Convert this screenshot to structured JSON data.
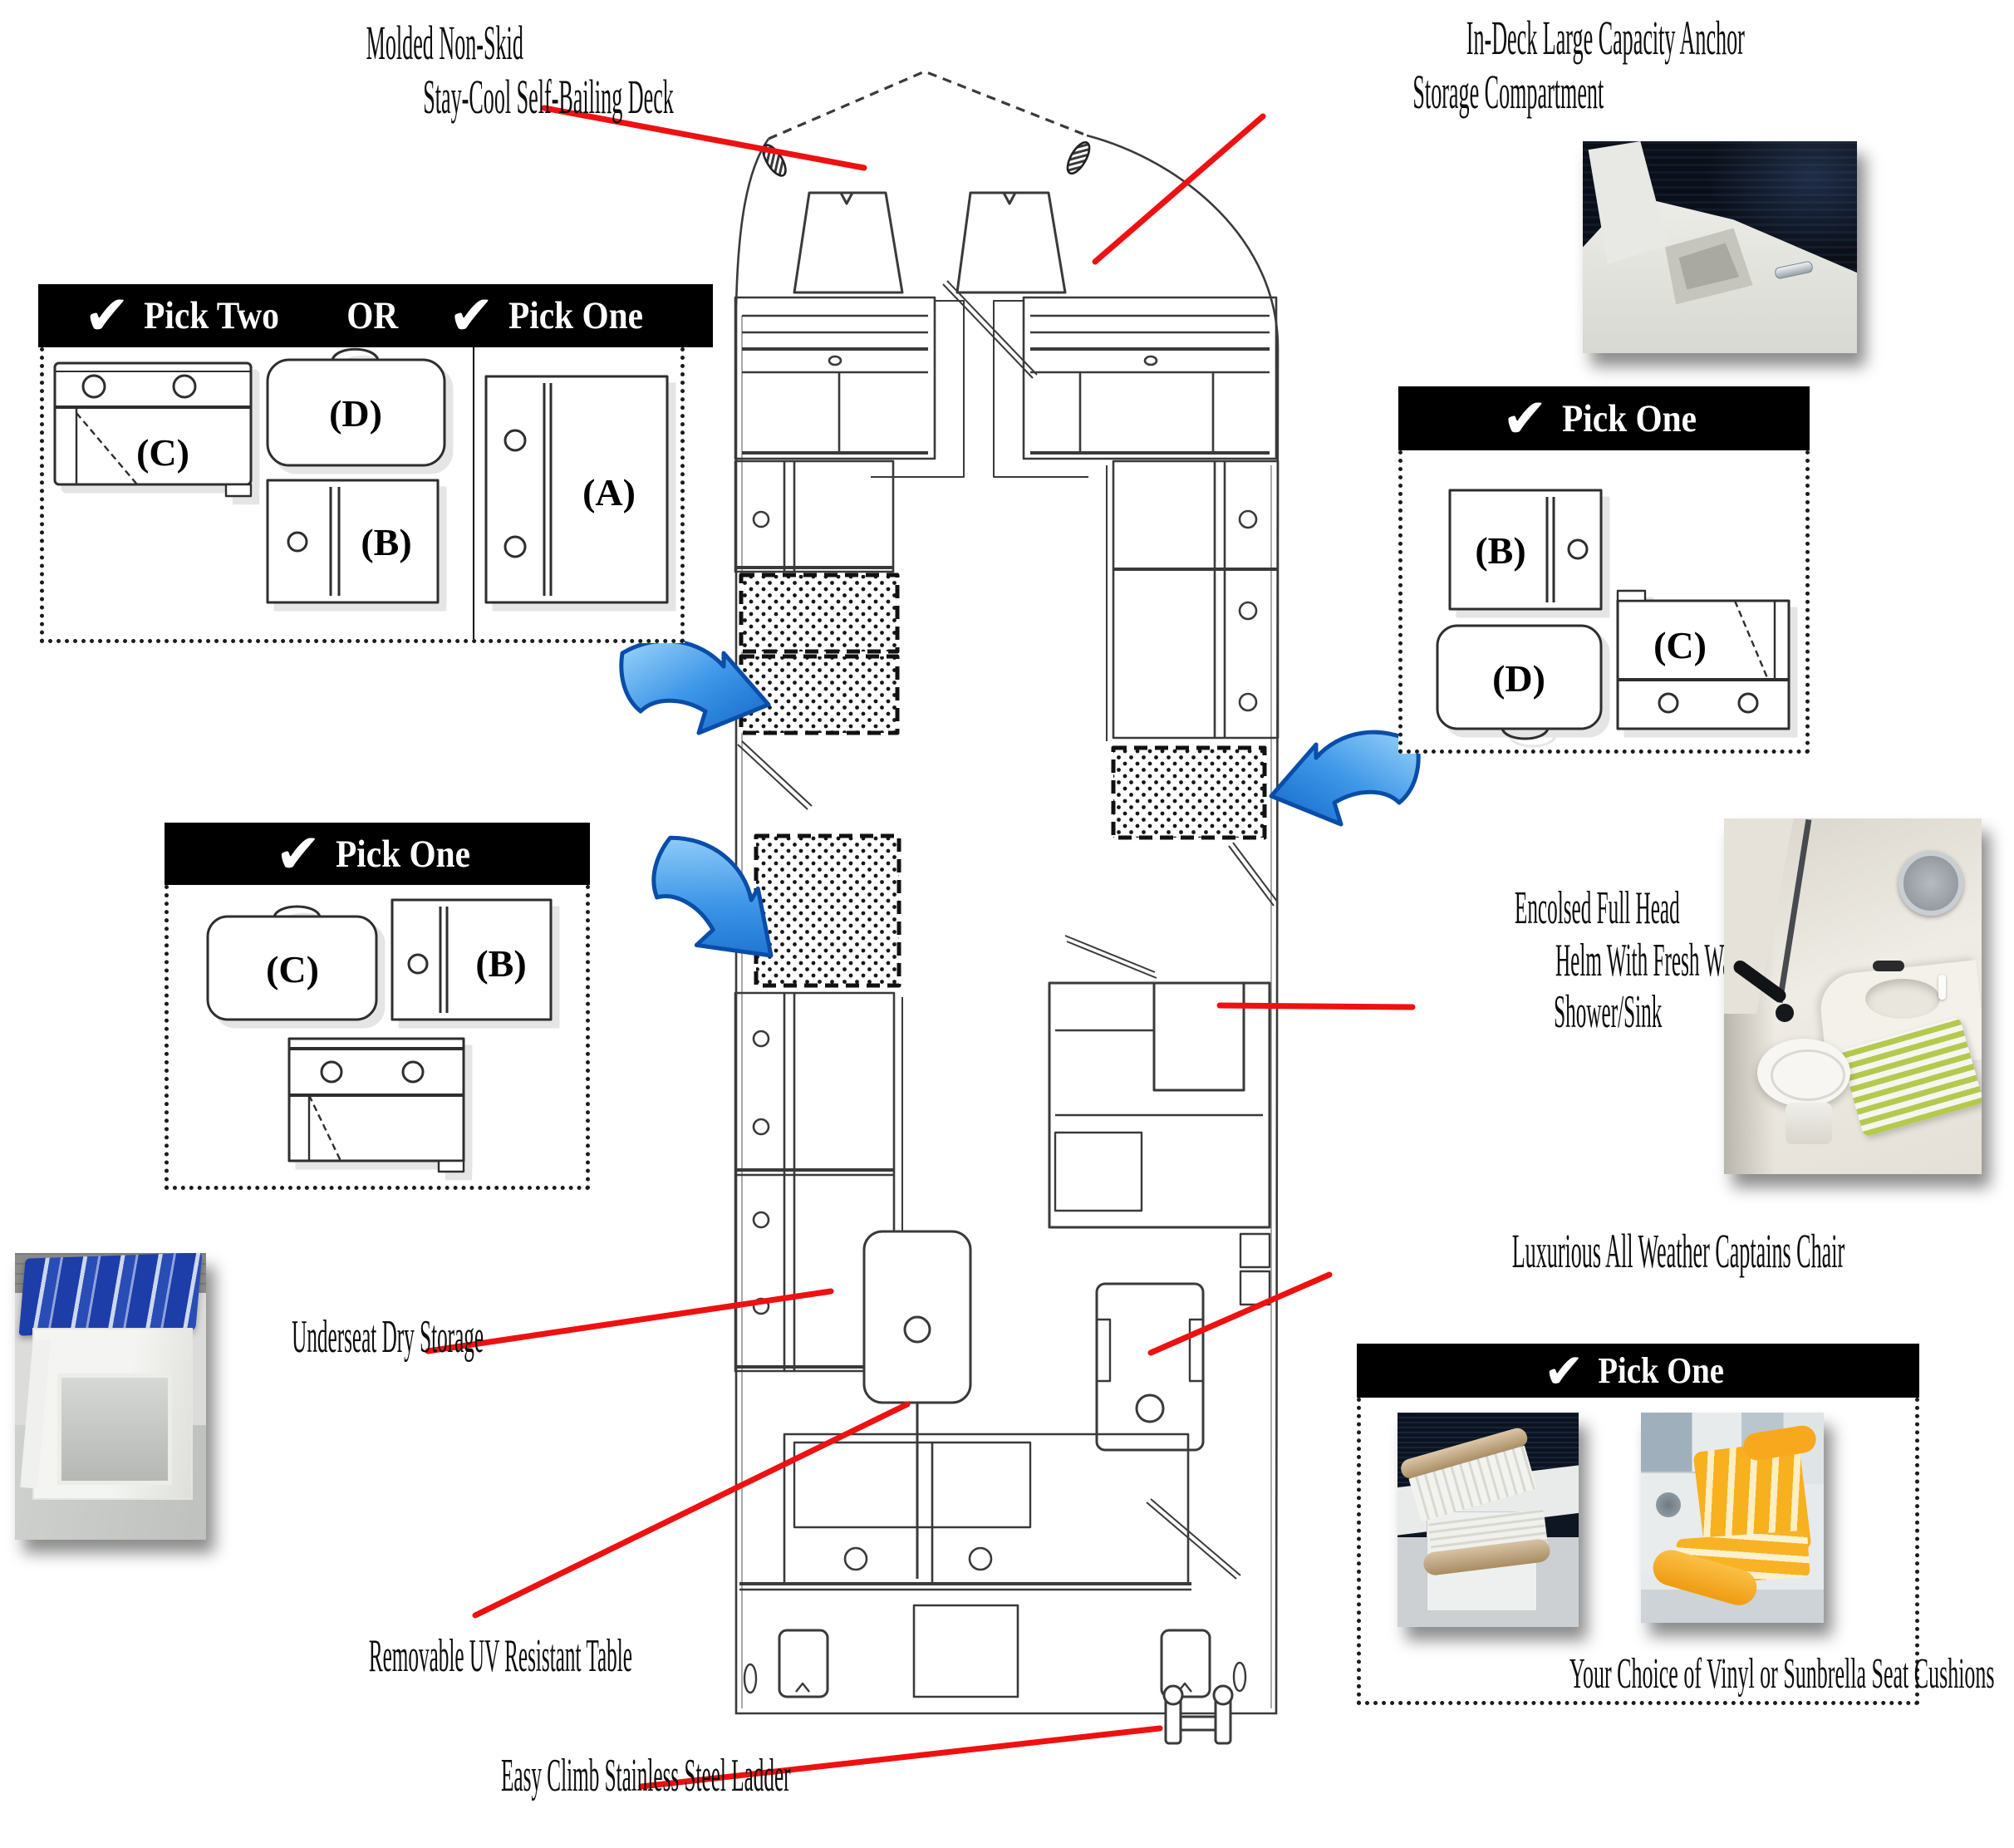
{
  "icons": {
    "check": "✔"
  },
  "labels": {
    "a": "(A)",
    "b": "(B)",
    "c": "(C)",
    "d": "(D)"
  },
  "callouts": {
    "deck_line1": "Molded Non-Skid",
    "deck_line2": "Stay-Cool Self-Bailing Deck",
    "anchor_line1": "In-Deck Large Capacity Anchor",
    "anchor_line2": "Storage Compartment",
    "head_line1": "Encolsed Full Head",
    "head_line2": "Helm With Fresh Water",
    "head_line3": "Shower/Sink",
    "chair": "Luxurious All Weather Captains Chair",
    "underseat": "Underseat Dry Storage",
    "table": "Removable UV Resistant Table",
    "ladder": "Easy Climb Stainless Steel Ladder"
  },
  "boxes": {
    "bow": {
      "pick_two": "Pick Two",
      "or": "OR",
      "pick_one": "Pick One"
    },
    "starboard": {
      "heading": "Pick One"
    },
    "port": {
      "heading": "Pick One"
    },
    "cushions": {
      "heading": "Pick One",
      "caption": "Your Choice of Vinyl or Sunbrella Seat Cushions"
    }
  },
  "colors": {
    "leader_line": "#ee1111",
    "arrow_blue": "#1266c8",
    "plan_line": "#3a3a3a"
  }
}
